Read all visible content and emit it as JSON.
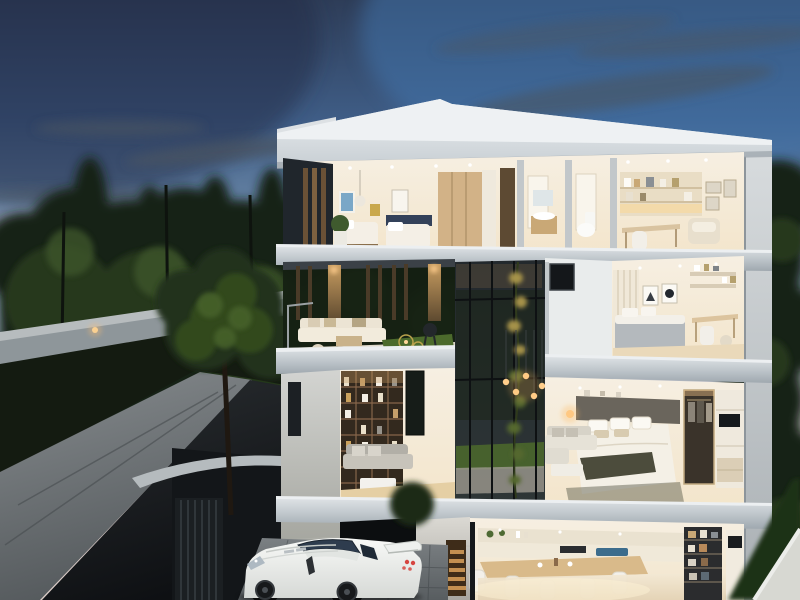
{
  "meta": {
    "description": "Dusk architectural rendering of a modern four-storey house shown as a cutaway doll-house section, surrounded by dark trees, with a driveway and a white sports car parked at a carport",
    "time_of_day": "dusk",
    "canvas": {
      "width": 800,
      "height": 600
    }
  },
  "colors": {
    "sky_top": "#2e3d58",
    "sky_mid": "#6f8cab",
    "sky_horizon": "#d9cbc6",
    "cloud": "#4a5663",
    "blue_boost": "#4277b0",
    "pink_glow": "#c29a94",
    "tree_dark": "#182414",
    "tree_mid": "#26371d",
    "tree_light": "#3c552c",
    "wall_concrete": "#8e969a",
    "wall_cap": "#b7bcbe",
    "ground_dark": "#141b11",
    "asphalt": "#2a2e31",
    "asphalt_dark": "#0e1013",
    "paver_light": "#868b8e",
    "paver_dark": "#54595c",
    "roof_light": "#eef1f3",
    "roof_face": "#c7ced3",
    "slab_light": "#dfe3e6",
    "slab_face": "#9fa8af",
    "room_light": "#f6efe2",
    "room_warm": "#f3e5cb",
    "facade_dark": "#20262c",
    "wood_post": "#a8824f",
    "wood_slat": "#4a3b28",
    "wood_shelf": "#33291e",
    "glass_dark": "#23292d",
    "lawn": "#4c6a2c",
    "vine_green": "#55682f",
    "vine_gold": "#a5924a",
    "pendant_glow": "#ffcf8e",
    "bedding_gray": "#b4b9bd",
    "throw_olive": "#4c4c3c",
    "poster_blue": "#7aa7c7",
    "poster_mustard": "#c9a84c",
    "accent_navy": "#33415a",
    "stair_wood": "#b8894f",
    "car_body": "#f8f9f7",
    "car_shade": "#d6d9d6",
    "car_glass": "#2e3c4e",
    "car_wheel": "#0a0b0c",
    "tail_light": "#d64540",
    "hedge": "#1f3116",
    "boundary_wall": "#d7d8d2",
    "kitchen_floor": "#f4ead6"
  },
  "scene": {
    "environment": {
      "sky": "gradient dusk sky, deep blue top fading to pink-gray horizon with wispy dark clouds",
      "vegetation": "dense dark evergreen trees left and behind house right",
      "boundary_wall": "lit concrete perimeter wall along tree line",
      "site": "stone footpath and dark asphalt driveway sloping to foreground, paver parking pad"
    },
    "building": {
      "type": "modern flat-roof four-storey villa, cutaway section with warm interior lighting",
      "floors": [
        {
          "level": 4,
          "rooms": [
            "kids bedroom with two twin beds and wall art",
            "bathroom with vanity and toilet",
            "study with lit shelves, desk, chair and armchair"
          ]
        },
        {
          "level": 3,
          "rooms": [
            "open terrace lounge with timber slat screen, bbq and lawn strip",
            "bedroom with triangle and circle framed art, bed and desk"
          ]
        },
        {
          "level": 2,
          "rooms": [
            "double-height living room with full-height bookshelf and gray sofa",
            "master bedroom with bed, olive throw, sofa, walk-in closet and tv wall"
          ]
        },
        {
          "level": 1,
          "rooms": [
            "kitchen and dining with long timber table and white chairs",
            "dark pantry shelving",
            "lit timber stair niche",
            "carport opening"
          ]
        }
      ]
    },
    "vehicle": {
      "type": "white sports coupe",
      "details": "black wheels, large rear wing, dark glasshouse, red tail lights, parked on pavers before the carport"
    }
  }
}
